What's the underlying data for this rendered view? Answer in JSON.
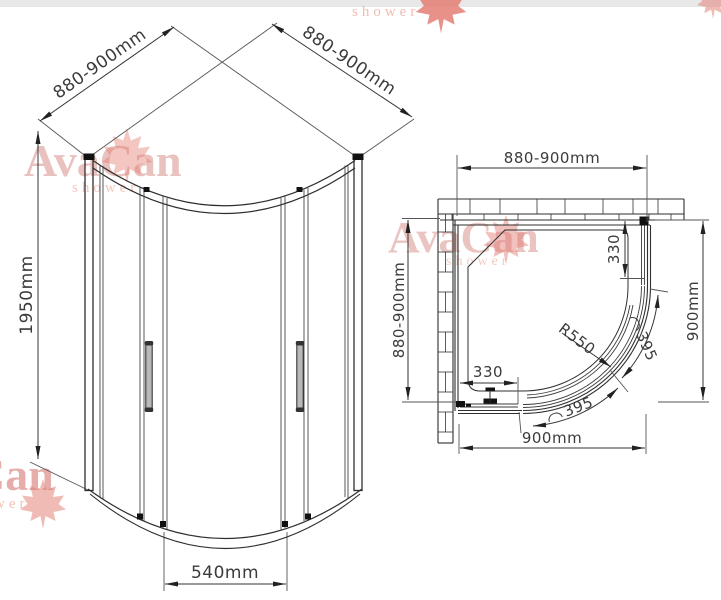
{
  "watermarks": {
    "front": {
      "brand": "AvaCan",
      "sub": "shower"
    },
    "plan": {
      "brand": "AvaCan",
      "sub": "shower"
    },
    "bottom_left": {
      "brand": "Can",
      "sub": "wer"
    },
    "top_right": {
      "sub": "shower"
    }
  },
  "front_view": {
    "dim_depth_left": "880-900mm",
    "dim_depth_right": "880-900mm",
    "dim_height": "1950mm",
    "dim_door_width": "540mm"
  },
  "plan_view": {
    "dim_width_top": "880-900mm",
    "dim_depth_left": "880-900mm",
    "dim_depth_right": "900mm",
    "dim_width_bottom": "900mm",
    "dim_fixed_right": "330",
    "dim_fixed_bottom": "330",
    "dim_radius": "R550",
    "dim_door_arc_bottom": "395",
    "dim_door_arc_right": "395"
  }
}
